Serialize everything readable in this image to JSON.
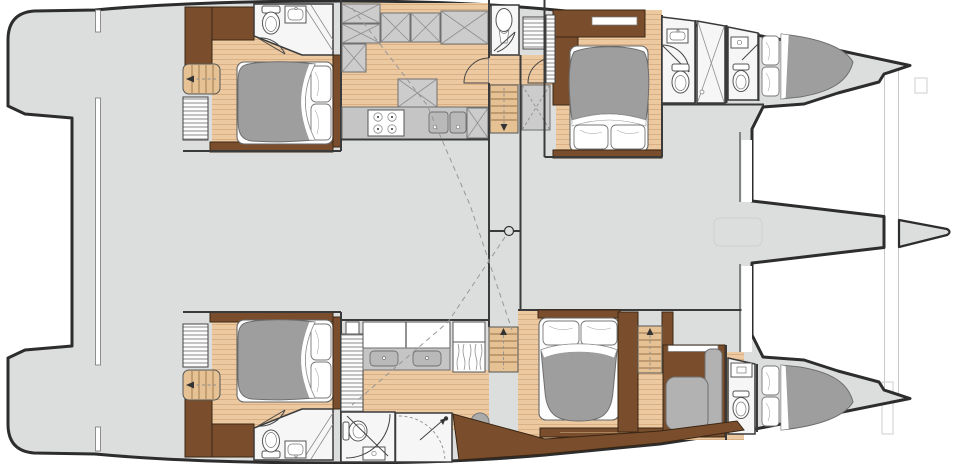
{
  "palette": {
    "background": "#ffffff",
    "hull_outline": "#2d2d2d",
    "deck": "#dcdddd",
    "wall": "#3a3a3a",
    "wood_floor": "#ecc9a1",
    "wood_stripe": "#d9b083",
    "stair_tread": "#e6c193",
    "cabinet_brown": "#7a4e2c",
    "cabinet_gray": "#cccccc",
    "counter_gray": "#c5c5c5",
    "bed_duvet": "#9e9e9e",
    "sofa_gray": "#b2b2b2",
    "bathroom_white": "#f6f6f6",
    "dashed_line": "#979797",
    "rigging_line": "#c9c9c9"
  },
  "inventory": {
    "double_beds": 4,
    "v_berths": 2,
    "toilets": 7,
    "showers": 5,
    "washbasins": 8,
    "galley_sink_basins": 2,
    "stove_burners": 4,
    "staircases": 6,
    "sofas": 1,
    "poufs": 1
  }
}
